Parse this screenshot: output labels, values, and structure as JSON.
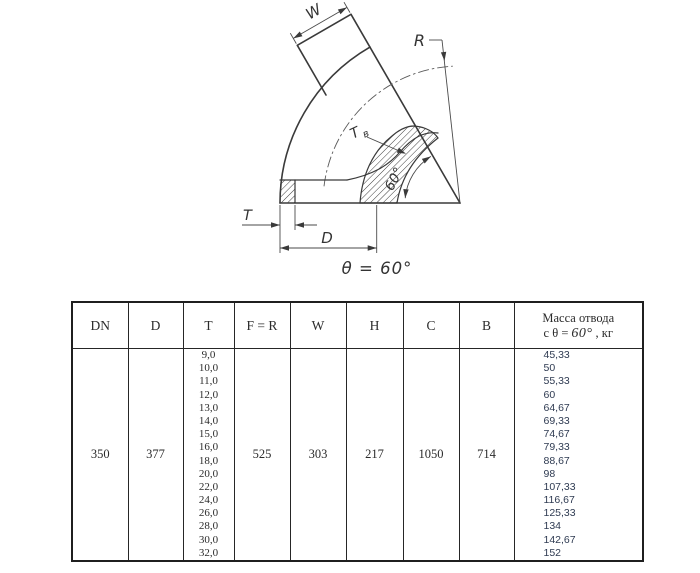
{
  "figure": {
    "caption": "θ = 60°",
    "labels": {
      "w": "W",
      "r": "R",
      "t": "T",
      "d": "D",
      "tv_main": "Т",
      "tv_sub": "в",
      "angle": "60°"
    }
  },
  "table": {
    "headers": {
      "dn": "DN",
      "d": "D",
      "t": "T",
      "fr": "F = R",
      "w": "W",
      "h": "H",
      "c": "C",
      "b": "B",
      "mass_line1": "Масса отвода",
      "mass_prefix": "с θ =",
      "mass_angle": "60°",
      "mass_suffix": ", кг"
    },
    "row": {
      "dn": "350",
      "d": "377",
      "fr": "525",
      "w": "303",
      "h": "217",
      "c": "1050",
      "b": "714",
      "t_values": [
        "9,0",
        "10,0",
        "11,0",
        "12,0",
        "13,0",
        "14,0",
        "15,0",
        "16,0",
        "18,0",
        "20,0",
        "22,0",
        "24,0",
        "26,0",
        "28,0",
        "30,0",
        "32,0"
      ],
      "mass_values": [
        "45,33",
        "50",
        "55,33",
        "60",
        "64,67",
        "69,33",
        "74,67",
        "79,33",
        "88,67",
        "98",
        "107,33",
        "116,67",
        "125,33",
        "134",
        "142,67",
        "152"
      ]
    },
    "colors": {
      "mass_text": "#2f3b52",
      "line_color": "#262626"
    }
  }
}
